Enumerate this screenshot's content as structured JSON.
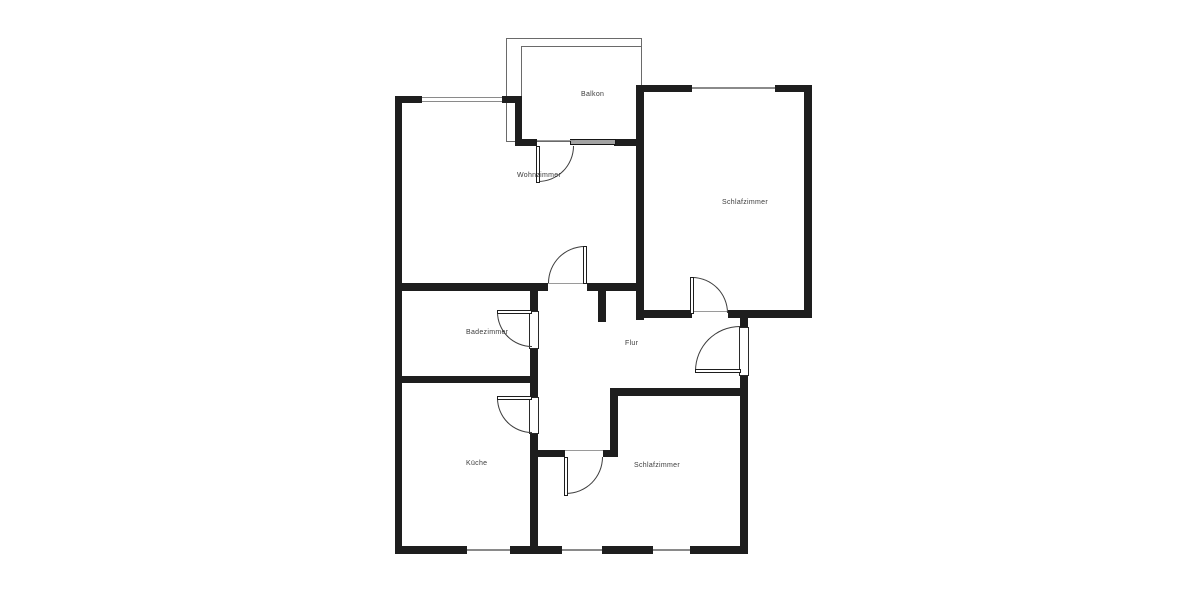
{
  "plan": {
    "type": "floor-plan",
    "colors": {
      "wall": "#1e1e1e",
      "thin_line": "#8a8a8a",
      "arc": "#3c3c3c",
      "label": "#3c3c3c",
      "background": "#ffffff"
    },
    "rooms": [
      {
        "id": "balkon",
        "label": "Balkon",
        "cx": 581,
        "cy": 91
      },
      {
        "id": "wohnzimmer",
        "label": "Wohnzimmer",
        "cx": 517,
        "cy": 172
      },
      {
        "id": "schlafzimmer-1",
        "label": "Schlafzimmer",
        "cx": 722,
        "cy": 199
      },
      {
        "id": "badezimmer",
        "label": "Badezimmer",
        "cx": 466,
        "cy": 329
      },
      {
        "id": "flur",
        "label": "Flur",
        "cx": 625,
        "cy": 340
      },
      {
        "id": "kueche",
        "label": "Küche",
        "cx": 466,
        "cy": 460
      },
      {
        "id": "schlafzimmer-2",
        "label": "Schlafzimmer",
        "cx": 634,
        "cy": 462
      }
    ],
    "walls": [
      {
        "id": "outer-left",
        "x": 395,
        "y": 96,
        "w": 7,
        "h": 458
      },
      {
        "id": "wohnzimmer-top-a",
        "x": 395,
        "y": 96,
        "w": 27,
        "h": 7
      },
      {
        "id": "wohnzimmer-top-b",
        "x": 502,
        "y": 96,
        "w": 20,
        "h": 7
      },
      {
        "id": "balcony-connector",
        "x": 515,
        "y": 96,
        "w": 7,
        "h": 50
      },
      {
        "id": "balcony-bottom-a",
        "x": 515,
        "y": 139,
        "w": 22,
        "h": 7
      },
      {
        "id": "balcony-bottom-b",
        "x": 614,
        "y": 139,
        "w": 28,
        "h": 7
      },
      {
        "id": "wohn-schlaf-divider",
        "x": 636,
        "y": 85,
        "w": 8,
        "h": 235
      },
      {
        "id": "schlafzimmer1-top-a",
        "x": 636,
        "y": 85,
        "w": 56,
        "h": 7
      },
      {
        "id": "schlafzimmer1-top-b",
        "x": 775,
        "y": 85,
        "w": 37,
        "h": 7
      },
      {
        "id": "schlafzimmer1-right",
        "x": 804,
        "y": 85,
        "w": 8,
        "h": 232
      },
      {
        "id": "schlafzimmer1-bottom-a",
        "x": 636,
        "y": 310,
        "w": 56,
        "h": 8
      },
      {
        "id": "schlafzimmer1-bottom-b",
        "x": 728,
        "y": 310,
        "w": 84,
        "h": 8
      },
      {
        "id": "wohnzimmer-bottom-a",
        "x": 395,
        "y": 283,
        "w": 153,
        "h": 8
      },
      {
        "id": "wohnzimmer-bottom-b",
        "x": 587,
        "y": 283,
        "w": 57,
        "h": 8
      },
      {
        "id": "flur-stub",
        "x": 598,
        "y": 291,
        "w": 8,
        "h": 31
      },
      {
        "id": "bad-kueche-right-a",
        "x": 530,
        "y": 283,
        "w": 8,
        "h": 29
      },
      {
        "id": "bad-kueche-right-b",
        "x": 530,
        "y": 348,
        "w": 8,
        "h": 50
      },
      {
        "id": "bad-kueche-right-c",
        "x": 530,
        "y": 433,
        "w": 8,
        "h": 121
      },
      {
        "id": "badezimmer-bottom",
        "x": 395,
        "y": 376,
        "w": 143,
        "h": 7
      },
      {
        "id": "entry-wall-a",
        "x": 740,
        "y": 317,
        "w": 8,
        "h": 11
      },
      {
        "id": "entry-wall-b",
        "x": 740,
        "y": 375,
        "w": 8,
        "h": 21
      },
      {
        "id": "schlafzimmer2-top",
        "x": 610,
        "y": 388,
        "w": 138,
        "h": 8
      },
      {
        "id": "schlafzimmer2-notch",
        "x": 610,
        "y": 388,
        "w": 8,
        "h": 69
      },
      {
        "id": "schlafzimmer2-left-a",
        "x": 538,
        "y": 450,
        "w": 27,
        "h": 7
      },
      {
        "id": "schlafzimmer2-left-b",
        "x": 603,
        "y": 450,
        "w": 15,
        "h": 7
      },
      {
        "id": "schlafzimmer2-right",
        "x": 740,
        "y": 388,
        "w": 8,
        "h": 166
      },
      {
        "id": "outer-bottom-a",
        "x": 395,
        "y": 546,
        "w": 72,
        "h": 8
      },
      {
        "id": "outer-bottom-b",
        "x": 510,
        "y": 546,
        "w": 52,
        "h": 8
      },
      {
        "id": "outer-bottom-c",
        "x": 602,
        "y": 546,
        "w": 51,
        "h": 8
      },
      {
        "id": "outer-bottom-d",
        "x": 690,
        "y": 546,
        "w": 58,
        "h": 8
      }
    ],
    "railings": [
      {
        "id": "balcony-railing-outer",
        "x": 506,
        "y": 38,
        "w": 136,
        "h": 104
      },
      {
        "id": "balcony-railing-inner",
        "x": 521,
        "y": 46,
        "w": 121,
        "h": 96
      }
    ],
    "windows": [
      {
        "id": "wohnzimmer-top-window",
        "x": 422,
        "y": 97,
        "w": 80,
        "h": 5,
        "kind": "double"
      },
      {
        "id": "schlafzimmer1-top-window",
        "x": 692,
        "y": 87,
        "w": 83,
        "h": 2,
        "kind": "single"
      },
      {
        "id": "kueche-bottom-window",
        "x": 467,
        "y": 549,
        "w": 43,
        "h": 2,
        "kind": "single"
      },
      {
        "id": "schlafzimmer2-window-1",
        "x": 562,
        "y": 549,
        "w": 40,
        "h": 2,
        "kind": "single"
      },
      {
        "id": "schlafzimmer2-window-2",
        "x": 653,
        "y": 549,
        "w": 37,
        "h": 2,
        "kind": "single"
      }
    ],
    "sills": [
      {
        "id": "balcony-window-sill",
        "x": 570,
        "y": 139,
        "w": 46,
        "h": 6
      }
    ],
    "door_frames": [
      {
        "id": "badezimmer-door-frame",
        "x": 529,
        "y": 311,
        "w": 10,
        "h": 38
      },
      {
        "id": "kueche-door-frame",
        "x": 529,
        "y": 397,
        "w": 10,
        "h": 37
      },
      {
        "id": "entry-door-frame",
        "x": 739,
        "y": 327,
        "w": 10,
        "h": 49
      }
    ],
    "thresholds": [
      {
        "id": "balcony-door-threshold",
        "x": 537,
        "y": 140,
        "w": 38,
        "h": 1
      },
      {
        "id": "wohnzimmer-door-threshold",
        "x": 548,
        "y": 283,
        "w": 39,
        "h": 1
      },
      {
        "id": "schlafzimmer1-door-threshold",
        "x": 692,
        "y": 311,
        "w": 36,
        "h": 1
      },
      {
        "id": "schlafzimmer2-door-threshold",
        "x": 565,
        "y": 450,
        "w": 38,
        "h": 1
      }
    ],
    "doors": [
      {
        "id": "balcony-door",
        "leaf": {
          "x": 536,
          "y": 146,
          "w": 4,
          "h": 37
        },
        "arc": {
          "x": 538,
          "y": 146,
          "r": 36,
          "corner": "br"
        }
      },
      {
        "id": "wohnzimmer-door",
        "leaf": {
          "x": 583,
          "y": 246,
          "w": 4,
          "h": 38
        },
        "arc": {
          "x": 548,
          "y": 246,
          "r": 37,
          "corner": "tl"
        }
      },
      {
        "id": "schlafzimmer1-door",
        "leaf": {
          "x": 690,
          "y": 277,
          "w": 4,
          "h": 37
        },
        "arc": {
          "x": 692,
          "y": 277,
          "r": 36,
          "corner": "tr"
        }
      },
      {
        "id": "entry-door",
        "leaf": {
          "x": 695,
          "y": 369,
          "w": 46,
          "h": 4
        },
        "arc": {
          "x": 695,
          "y": 326,
          "r": 45,
          "corner": "tl"
        }
      },
      {
        "id": "badezimmer-door",
        "leaf": {
          "x": 497,
          "y": 310,
          "w": 35,
          "h": 4
        },
        "arc": {
          "x": 497,
          "y": 312,
          "r": 35,
          "corner": "bl"
        }
      },
      {
        "id": "kueche-door",
        "leaf": {
          "x": 497,
          "y": 396,
          "w": 35,
          "h": 4
        },
        "arc": {
          "x": 497,
          "y": 398,
          "r": 35,
          "corner": "bl"
        }
      },
      {
        "id": "schlafzimmer2-door",
        "leaf": {
          "x": 564,
          "y": 457,
          "w": 4,
          "h": 39
        },
        "arc": {
          "x": 566,
          "y": 457,
          "r": 37,
          "corner": "br"
        }
      }
    ]
  }
}
